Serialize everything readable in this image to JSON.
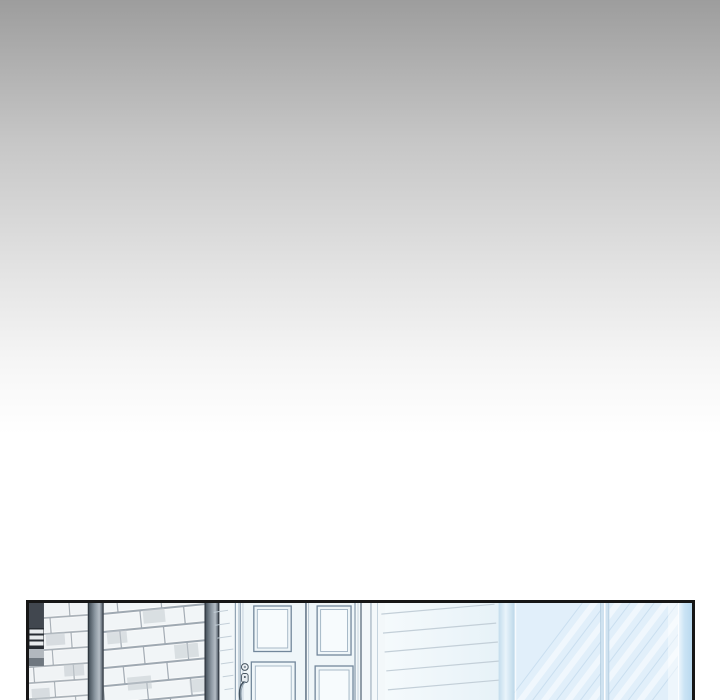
{
  "scene": {
    "description": "webtoon panel of a building entrance: brick wall corner with dark metal pillars, white paneled double door with knob and pull handle, horizontal clapboard siding, pale blue glass wall with diagonal reflections",
    "elements": [
      "gate-post",
      "brick-wall-left",
      "metal-post-left",
      "brick-wall-right",
      "metal-post-right",
      "side-wall-strip",
      "entrance-doors",
      "door-knob",
      "door-handle",
      "clapboard-siding",
      "corner-trim",
      "glass-wall",
      "glass-mullion",
      "glass-edge-strip"
    ]
  },
  "colors": {
    "bg_top": "#9d9d9d",
    "bg_bottom": "#ffffff",
    "panel_border": "#161616",
    "mortar": "#a6aeb5",
    "brick": "#f0f3f5",
    "brick_shade": "#c3cacf",
    "mortar_b": "#9fa9b2",
    "brick_b": "#f1f5f7",
    "post_edge": "#2e363e",
    "gate_dark": "#41474f",
    "gate_slot_bg": "#272c32",
    "gate_slot": "#e8ebed",
    "gate_gray": "#b2b8be",
    "gate_midgray": "#6f777f",
    "door_fill": "#f3f8fa",
    "door_leaf": "#eff6f9",
    "door_line": "#72879b",
    "door_line_light": "#9fb2c2",
    "door_inner": "#f7fbfd",
    "hardware": "#44535f",
    "jamb_dark": "#5d6d7d",
    "jamb_mid": "#90a2b2",
    "jamb_light": "#bccbd7",
    "siding_line": "#c3cfd8",
    "glass": "#e1effa",
    "glass_line": "#cadff0",
    "mullion": "#cfe2f0"
  }
}
